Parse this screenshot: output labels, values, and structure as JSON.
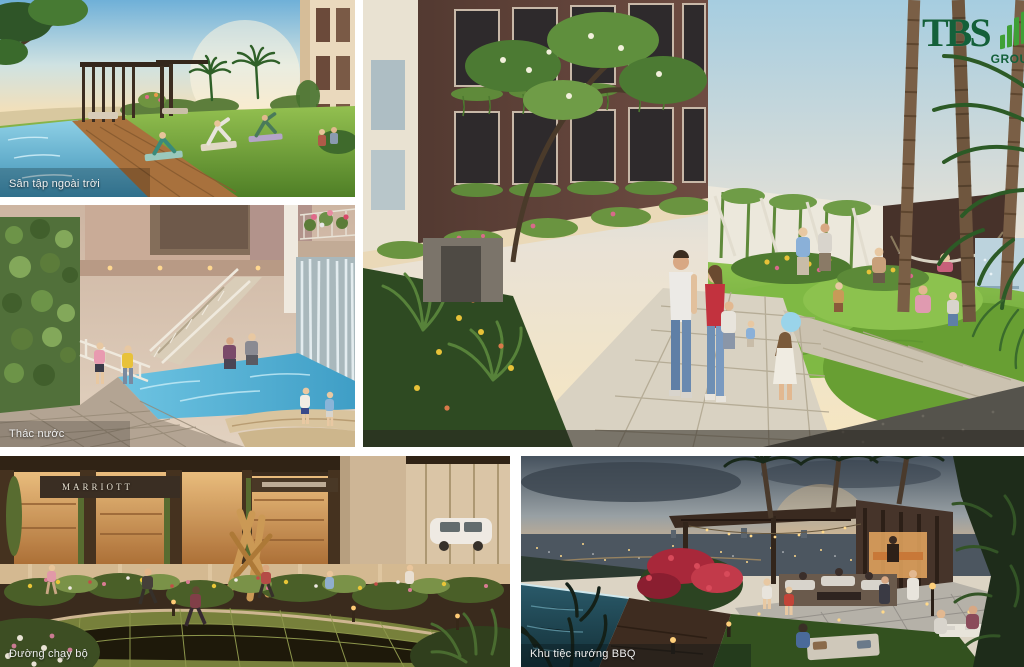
{
  "logo": {
    "name": "TBS",
    "suffix": "GROUP",
    "dark_green": "#14603a",
    "leaf_green": "#3fa036"
  },
  "panels": {
    "yoga": {
      "label": "Sân tập ngoài trời"
    },
    "waterfall": {
      "label": "Thác nước"
    },
    "courtyard": {
      "label": ""
    },
    "jogging": {
      "label": "Đường chạy bộ",
      "signage": "MARRIOTT"
    },
    "bbq": {
      "label": "Khu tiệc nướng BBQ"
    }
  },
  "palette": {
    "lawn_green": "#74ad3a",
    "pool_blue": "#4fb2d8",
    "facade_brown": "#5e4238",
    "dusk_sky": "#46525e",
    "warm_glow": "#e8bf82"
  }
}
